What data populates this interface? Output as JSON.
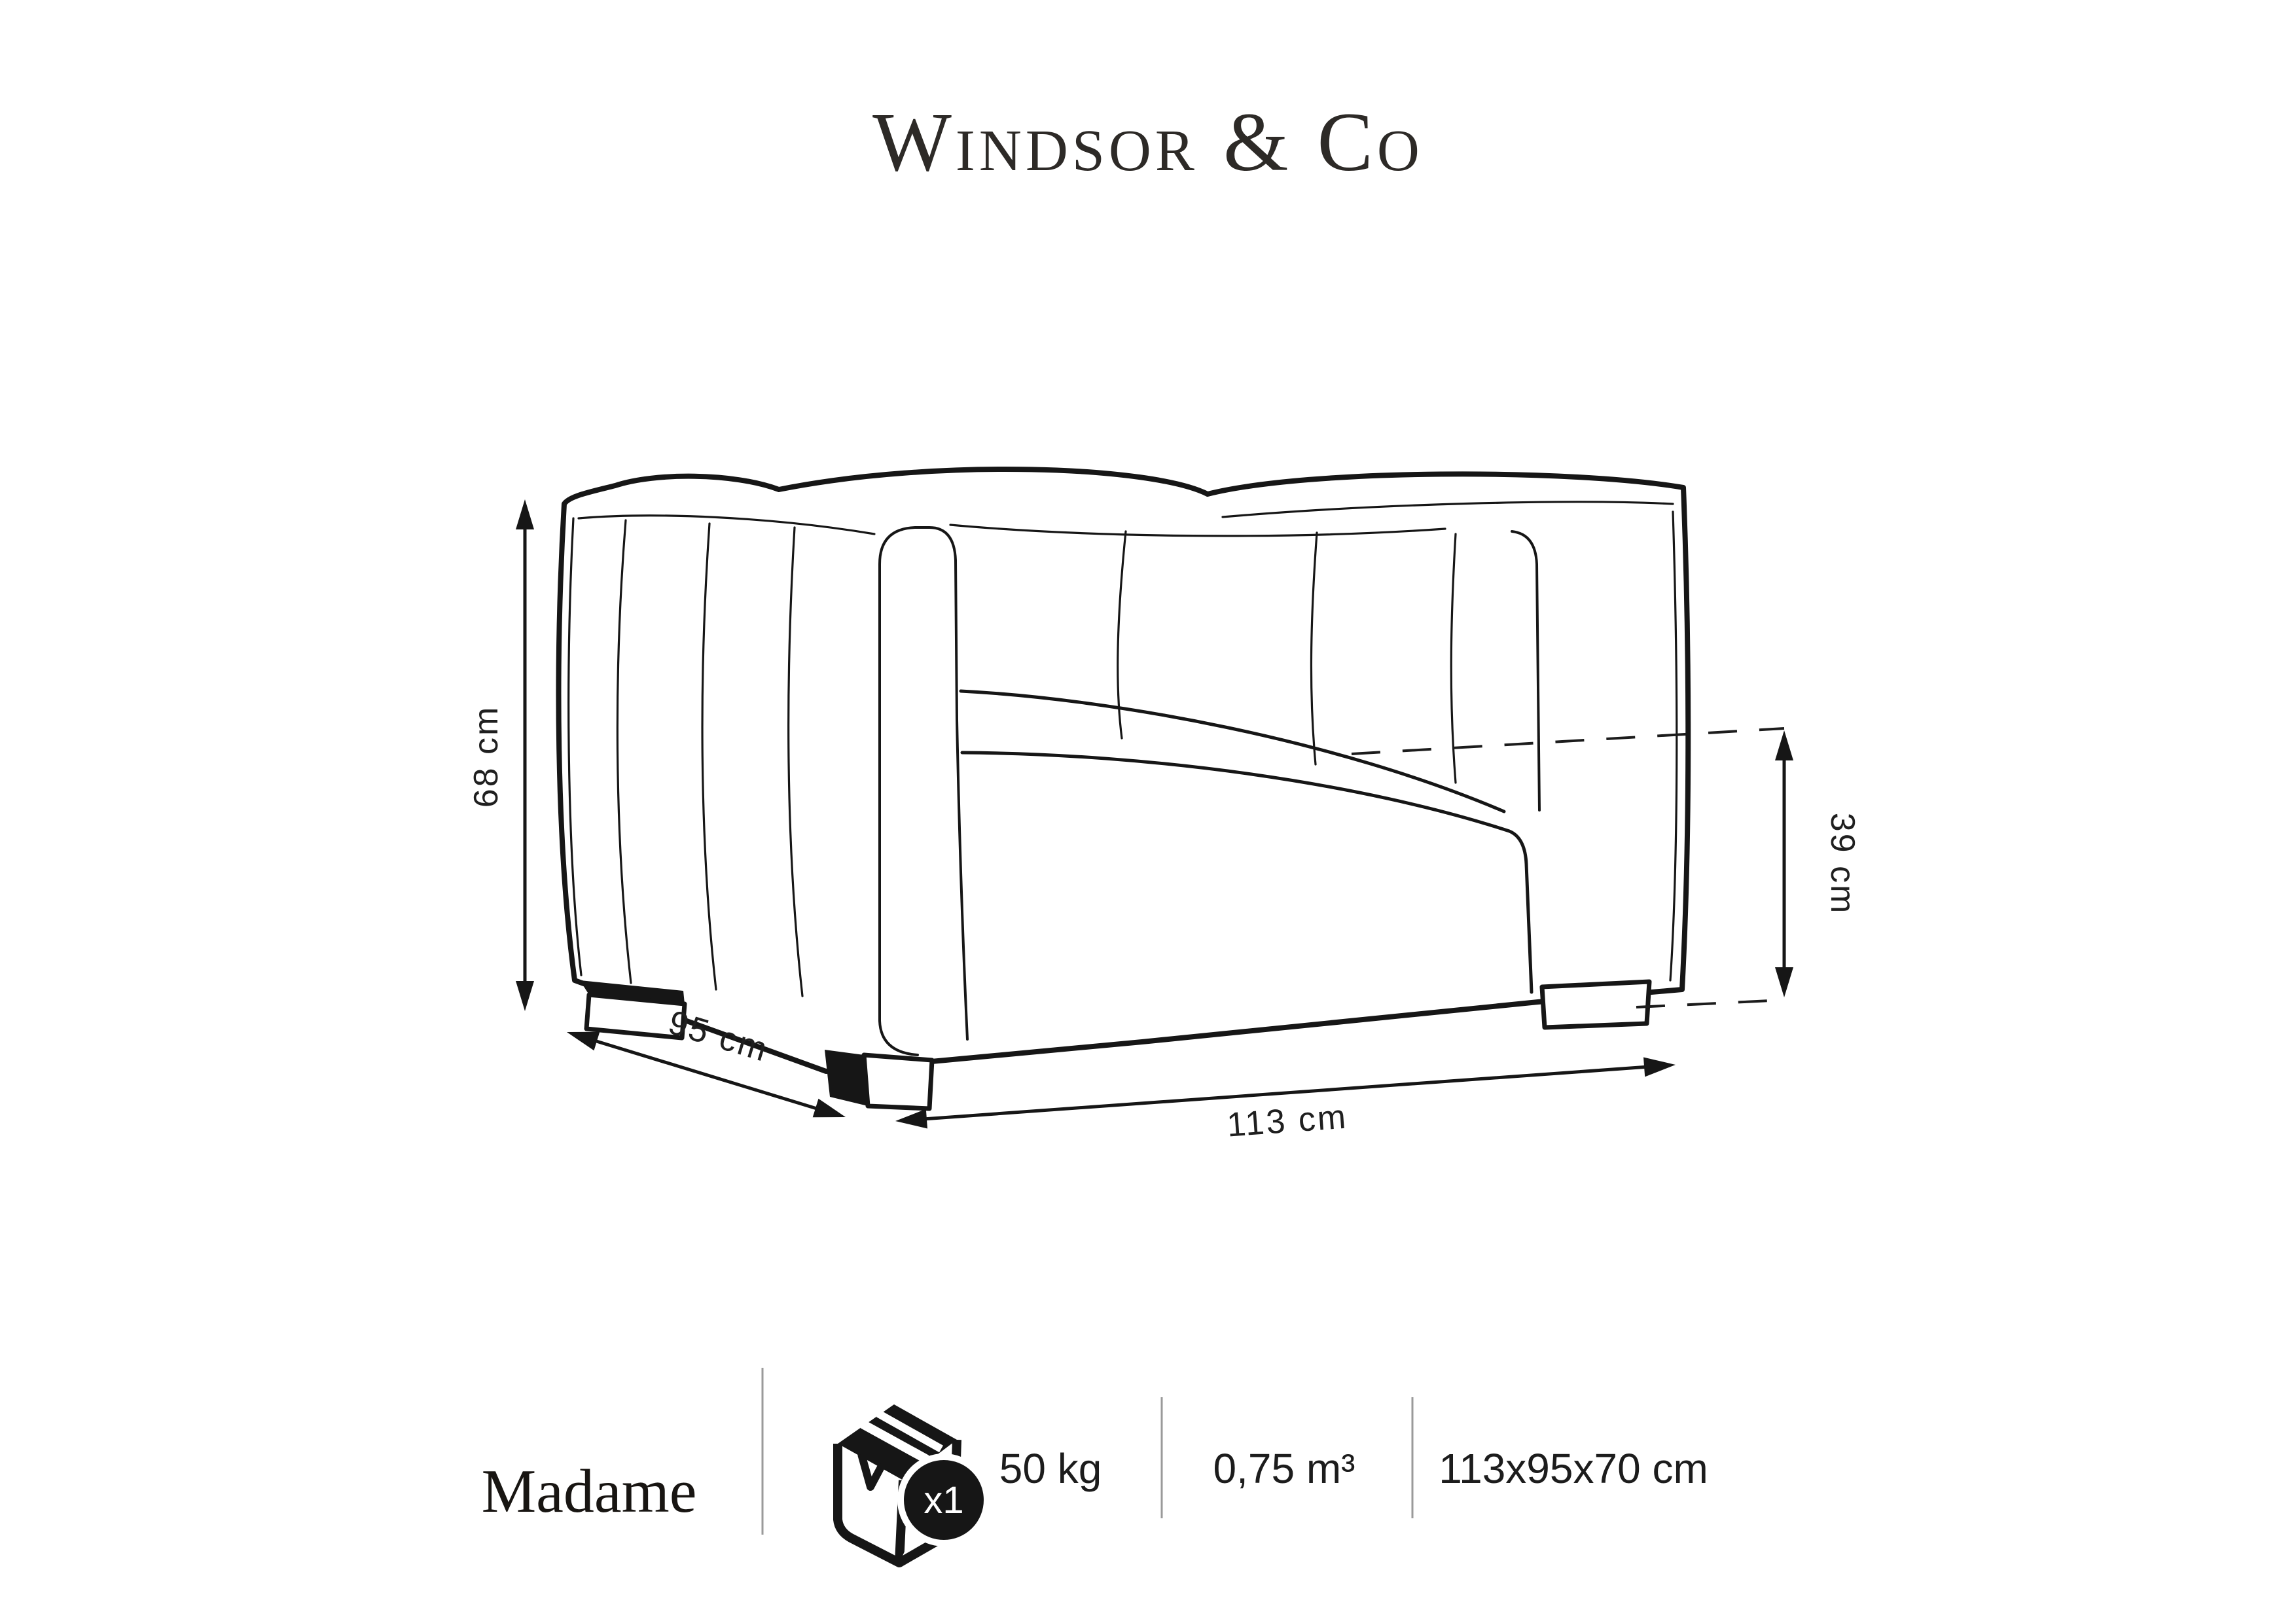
{
  "brand": {
    "logo_text": "Windsor & Co"
  },
  "diagram": {
    "type": "furniture-dimension-drawing",
    "product": "armchair",
    "dimensions": {
      "height": "68 cm",
      "depth": "95 cm",
      "width": "113 cm",
      "seat_height": "39 cm"
    }
  },
  "info_bar": {
    "product_name": "Madame",
    "package": {
      "icon": "box-icon",
      "count_badge": "x1"
    },
    "weight": "50 kg",
    "volume": "0,75 m³",
    "box_dimensions": "113x95x70 cm"
  },
  "colors": {
    "line": "#161616",
    "text": "#1f1f1f",
    "divider": "#9a9a9a",
    "background": "#ffffff"
  }
}
